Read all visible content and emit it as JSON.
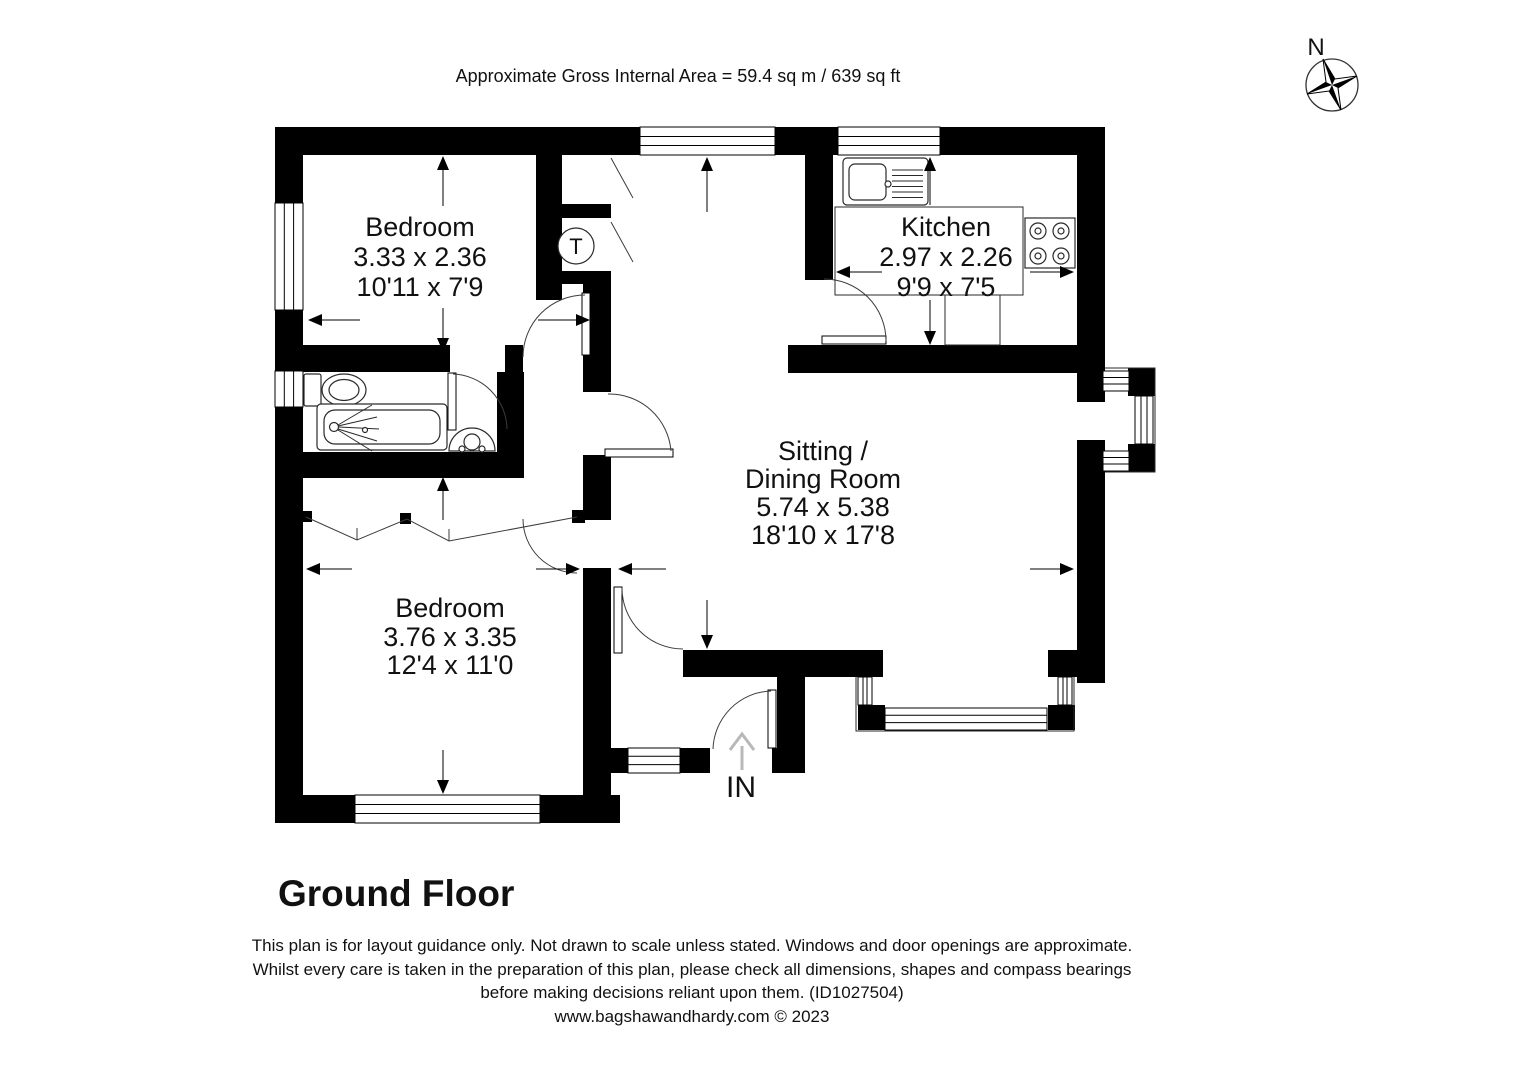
{
  "header": {
    "area_label": "Approximate Gross Internal Area = 59.4 sq m / 639 sq ft"
  },
  "compass": {
    "north_label": "N"
  },
  "rooms": [
    {
      "name": "Bedroom",
      "metric_dimensions": "3.33 x 2.36",
      "imperial_dimensions": "10'11 x 7'9"
    },
    {
      "name": "Kitchen",
      "metric_dimensions": "2.97 x 2.26",
      "imperial_dimensions": "9'9 x 7'5"
    },
    {
      "name_line1": "Sitting /",
      "name_line2": "Dining Room",
      "metric_dimensions": "5.74 x 5.38",
      "imperial_dimensions": "18'10 x 17'8"
    },
    {
      "name": "Bedroom",
      "metric_dimensions": "3.76 x 3.35",
      "imperial_dimensions": "12'4 x 11'0"
    }
  ],
  "annotations": {
    "tank_label": "T",
    "entrance_label": "IN"
  },
  "floor": {
    "title": "Ground Floor"
  },
  "footer": {
    "disclaimer_line1": "This plan is for layout guidance only. Not drawn to scale unless stated. Windows and door openings are approximate.",
    "disclaimer_line2": "Whilst every care is taken in the preparation of this plan, please check all dimensions, shapes and compass bearings",
    "disclaimer_line3": "before making decisions reliant upon them. (ID1027504)",
    "website_line": "www.bagshawandhardy.com © 2023"
  }
}
